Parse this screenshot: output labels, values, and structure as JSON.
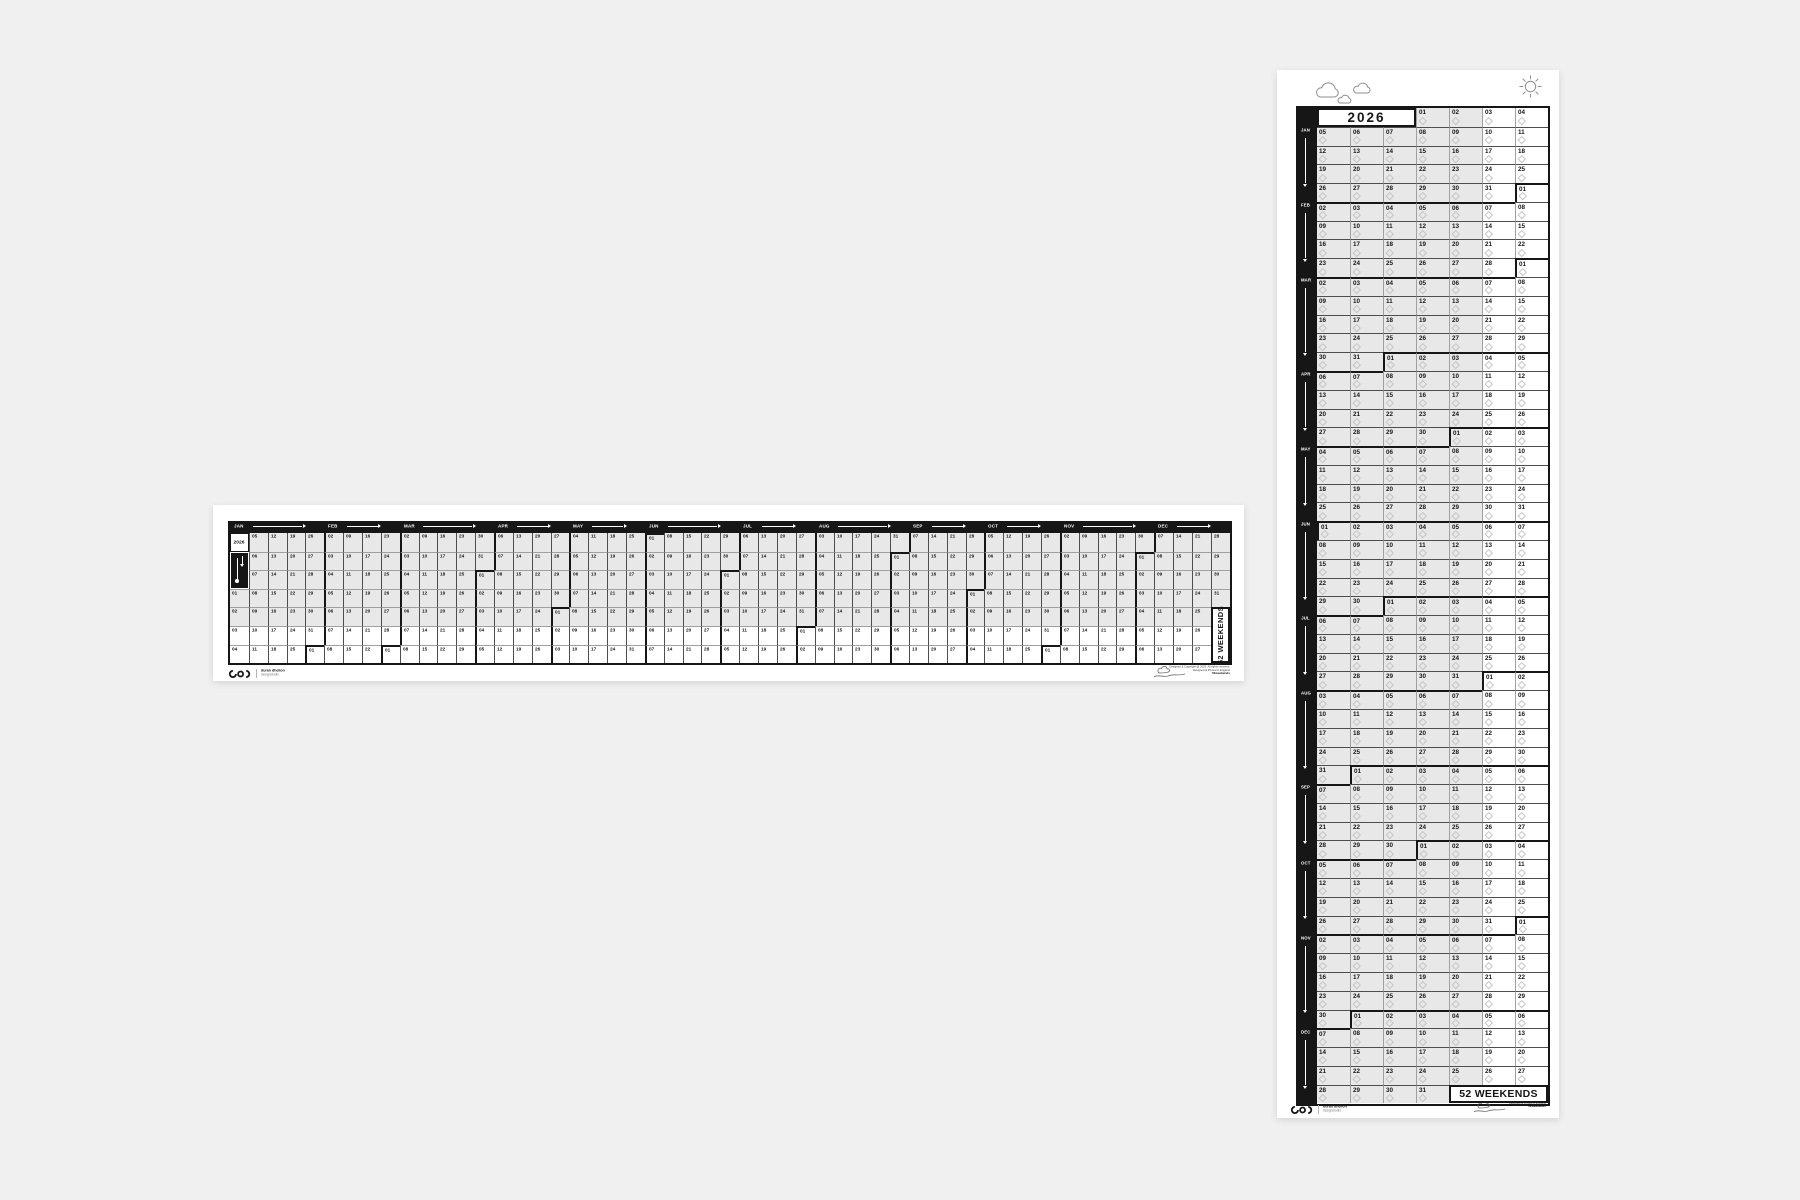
{
  "year": "2026",
  "tagline": "52 WEEKENDS",
  "weeks": [
    [
      null,
      null,
      null,
      "01",
      "02",
      "03",
      "04"
    ],
    [
      "05",
      "06",
      "07",
      "08",
      "09",
      "10",
      "11"
    ],
    [
      "12",
      "13",
      "14",
      "15",
      "16",
      "17",
      "18"
    ],
    [
      "19",
      "20",
      "21",
      "22",
      "23",
      "24",
      "25"
    ],
    [
      "26",
      "27",
      "28",
      "29",
      "30",
      "31",
      "01"
    ],
    [
      "02",
      "03",
      "04",
      "05",
      "06",
      "07",
      "08"
    ],
    [
      "09",
      "10",
      "11",
      "12",
      "13",
      "14",
      "15"
    ],
    [
      "16",
      "17",
      "18",
      "19",
      "20",
      "21",
      "22"
    ],
    [
      "23",
      "24",
      "25",
      "26",
      "27",
      "28",
      "01"
    ],
    [
      "02",
      "03",
      "04",
      "05",
      "06",
      "07",
      "08"
    ],
    [
      "09",
      "10",
      "11",
      "12",
      "13",
      "14",
      "15"
    ],
    [
      "16",
      "17",
      "18",
      "19",
      "20",
      "21",
      "22"
    ],
    [
      "23",
      "24",
      "25",
      "26",
      "27",
      "28",
      "29"
    ],
    [
      "30",
      "31",
      "01",
      "02",
      "03",
      "04",
      "05"
    ],
    [
      "06",
      "07",
      "08",
      "09",
      "10",
      "11",
      "12"
    ],
    [
      "13",
      "14",
      "15",
      "16",
      "17",
      "18",
      "19"
    ],
    [
      "20",
      "21",
      "22",
      "23",
      "24",
      "25",
      "26"
    ],
    [
      "27",
      "28",
      "29",
      "30",
      "01",
      "02",
      "03"
    ],
    [
      "04",
      "05",
      "06",
      "07",
      "08",
      "09",
      "10"
    ],
    [
      "11",
      "12",
      "13",
      "14",
      "15",
      "16",
      "17"
    ],
    [
      "18",
      "19",
      "20",
      "21",
      "22",
      "23",
      "24"
    ],
    [
      "25",
      "26",
      "27",
      "28",
      "29",
      "30",
      "31"
    ],
    [
      "01",
      "02",
      "03",
      "04",
      "05",
      "06",
      "07"
    ],
    [
      "08",
      "09",
      "10",
      "11",
      "12",
      "13",
      "14"
    ],
    [
      "15",
      "16",
      "17",
      "18",
      "19",
      "20",
      "21"
    ],
    [
      "22",
      "23",
      "24",
      "25",
      "26",
      "27",
      "28"
    ],
    [
      "29",
      "30",
      "01",
      "02",
      "03",
      "04",
      "05"
    ],
    [
      "06",
      "07",
      "08",
      "09",
      "10",
      "11",
      "12"
    ],
    [
      "13",
      "14",
      "15",
      "16",
      "17",
      "18",
      "19"
    ],
    [
      "20",
      "21",
      "22",
      "23",
      "24",
      "25",
      "26"
    ],
    [
      "27",
      "28",
      "29",
      "30",
      "31",
      "01",
      "02"
    ],
    [
      "03",
      "04",
      "05",
      "06",
      "07",
      "08",
      "09"
    ],
    [
      "10",
      "11",
      "12",
      "13",
      "14",
      "15",
      "16"
    ],
    [
      "17",
      "18",
      "19",
      "20",
      "21",
      "22",
      "23"
    ],
    [
      "24",
      "25",
      "26",
      "27",
      "28",
      "29",
      "30"
    ],
    [
      "31",
      "01",
      "02",
      "03",
      "04",
      "05",
      "06"
    ],
    [
      "07",
      "08",
      "09",
      "10",
      "11",
      "12",
      "13"
    ],
    [
      "14",
      "15",
      "16",
      "17",
      "18",
      "19",
      "20"
    ],
    [
      "21",
      "22",
      "23",
      "24",
      "25",
      "26",
      "27"
    ],
    [
      "28",
      "29",
      "30",
      "01",
      "02",
      "03",
      "04"
    ],
    [
      "05",
      "06",
      "07",
      "08",
      "09",
      "10",
      "11"
    ],
    [
      "12",
      "13",
      "14",
      "15",
      "16",
      "17",
      "18"
    ],
    [
      "19",
      "20",
      "21",
      "22",
      "23",
      "24",
      "25"
    ],
    [
      "26",
      "27",
      "28",
      "29",
      "30",
      "31",
      "01"
    ],
    [
      "02",
      "03",
      "04",
      "05",
      "06",
      "07",
      "08"
    ],
    [
      "09",
      "10",
      "11",
      "12",
      "13",
      "14",
      "15"
    ],
    [
      "16",
      "17",
      "18",
      "19",
      "20",
      "21",
      "22"
    ],
    [
      "23",
      "24",
      "25",
      "26",
      "27",
      "28",
      "29"
    ],
    [
      "30",
      "01",
      "02",
      "03",
      "04",
      "05",
      "06"
    ],
    [
      "07",
      "08",
      "09",
      "10",
      "11",
      "12",
      "13"
    ],
    [
      "14",
      "15",
      "16",
      "17",
      "18",
      "19",
      "20"
    ],
    [
      "21",
      "22",
      "23",
      "24",
      "25",
      "26",
      "27"
    ],
    [
      "28",
      "29",
      "30",
      "31",
      null,
      null,
      null
    ]
  ],
  "months": [
    {
      "label": "JAN",
      "start": 0,
      "v_start": 1,
      "end": 4
    },
    {
      "label": "FEB",
      "start": 5,
      "v_start": 5,
      "end": 8
    },
    {
      "label": "MAR",
      "start": 9,
      "v_start": 9,
      "end": 13
    },
    {
      "label": "APR",
      "start": 14,
      "v_start": 14,
      "end": 17
    },
    {
      "label": "MAY",
      "start": 18,
      "v_start": 18,
      "end": 21
    },
    {
      "label": "JUN",
      "start": 22,
      "v_start": 22,
      "end": 26
    },
    {
      "label": "JUL",
      "start": 27,
      "v_start": 27,
      "end": 30
    },
    {
      "label": "AUG",
      "start": 31,
      "v_start": 31,
      "end": 35
    },
    {
      "label": "SEP",
      "start": 36,
      "v_start": 36,
      "end": 39
    },
    {
      "label": "OCT",
      "start": 40,
      "v_start": 40,
      "end": 43
    },
    {
      "label": "NOV",
      "start": 44,
      "v_start": 44,
      "end": 48
    },
    {
      "label": "DEC",
      "start": 49,
      "v_start": 49,
      "end": 52
    }
  ],
  "brand": {
    "name": "duran dhelion",
    "sub": "designstudio"
  },
  "legal": {
    "line1": "Designed & Copyright @ 2025. All rights reserved.",
    "line2": "Designed & Printed in England",
    "line3": "52weekends"
  },
  "colors": {
    "ink": "#161616",
    "weekday_fill": "#e8e8e8",
    "weekend_fill": "#ffffff",
    "week_line": "#4e4e4e",
    "day_line": "#a0a0a0",
    "page_bg": "#f0f0f0",
    "icon_stroke": "#8f8f8f"
  },
  "icons": [
    "cloud-icon",
    "sun-icon",
    "down-arrow-icon",
    "right-arrow-icon",
    "diamond-icon",
    "brand-logo-icon",
    "signature-icon"
  ]
}
